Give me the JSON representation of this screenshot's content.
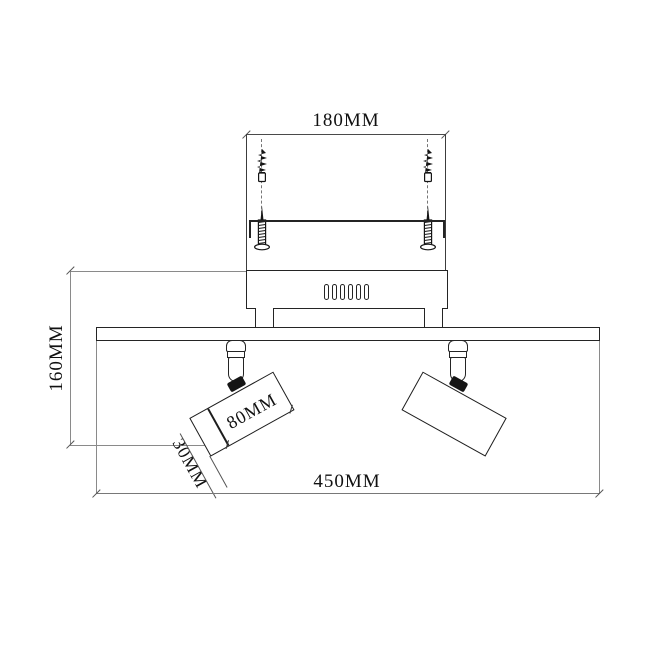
{
  "labels": {
    "bracket_width": "180MM",
    "fixture_height": "160MM",
    "fixture_width": "450MM",
    "head_length": "80MM",
    "head_diameter": "30MM"
  },
  "colors": {
    "object_line": "#242424",
    "dimension_line": "#8a8a8a",
    "dark_fill": "#151515",
    "background": "#ffffff"
  }
}
